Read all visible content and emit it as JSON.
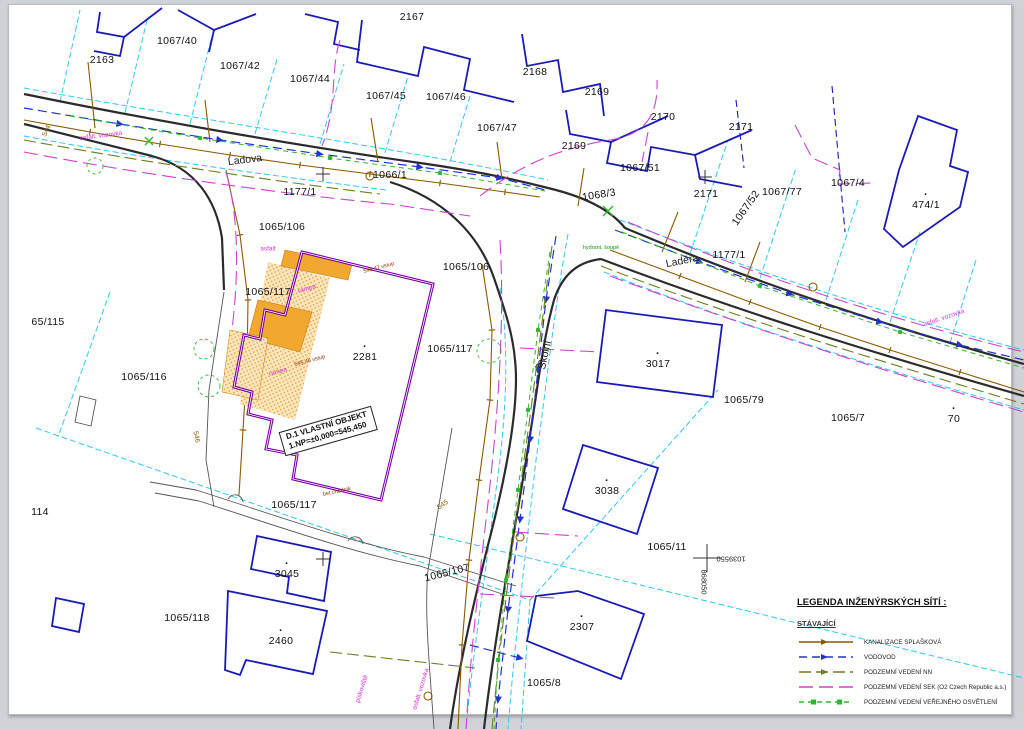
{
  "map": {
    "building_label": {
      "line1": "D.1 VLASTNÍ OBJEKT",
      "line2": "1.NP=±0,000=545,450"
    },
    "legend": {
      "title": "LEGENDA INŽENÝRSKÝCH SÍTÍ :",
      "subtitle": "STÁVAJÍCÍ",
      "items": [
        {
          "label": "KANALIZACE SPLAŠKOVÁ",
          "color": "#8a5a00",
          "dash": "",
          "arrow": true,
          "nodes": false
        },
        {
          "label": "VODOVOD",
          "color": "#2233cc",
          "dash": "8 5",
          "arrow": true,
          "nodes": false
        },
        {
          "label": "PODZEMNÍ VEDENÍ NN",
          "color": "#6f7d20",
          "dash": "12 5",
          "arrow": true,
          "nodes": false
        },
        {
          "label": "PODZEMNÍ VEDENÍ SEK (O2 Czech Republic a.s.)",
          "color": "#cc44cc",
          "dash": "14 6",
          "arrow": false,
          "nodes": false
        },
        {
          "label": "PODZEMNÍ VEDENÍ VEŘEJNÉHO OSVĚTLENÍ",
          "color": "#2eb82e",
          "dash": "5 4",
          "arrow": false,
          "nodes": true
        }
      ]
    },
    "colors": {
      "parcel_line": "#1b1bb4",
      "cadastral_line": "#33c6f0",
      "road_line": "#2b2b2b",
      "sewer": "#8a5a00",
      "water": "#2233cc",
      "power_nn": "#6f7d20",
      "sek": "#cc44cc",
      "lighting": "#2eb82e",
      "building_outline": "#7a00a6",
      "building_fill": "#f5a93c"
    },
    "labels": [
      {
        "name": "parcel-2167",
        "text": "2167",
        "x": 412,
        "y": 17,
        "cls": "p"
      },
      {
        "name": "parcel-1067-40",
        "text": "1067/40",
        "x": 177,
        "y": 41,
        "cls": "p"
      },
      {
        "name": "parcel-2163",
        "text": "2163",
        "x": 102,
        "y": 60,
        "cls": "p"
      },
      {
        "name": "parcel-1067-42",
        "text": "1067/42",
        "x": 240,
        "y": 66,
        "cls": "p"
      },
      {
        "name": "parcel-1067-44",
        "text": "1067/44",
        "x": 310,
        "y": 79,
        "cls": "p"
      },
      {
        "name": "parcel-2168",
        "text": "2168",
        "x": 535,
        "y": 72,
        "cls": "p"
      },
      {
        "name": "parcel-1067-45",
        "text": "1067/45",
        "x": 386,
        "y": 96,
        "cls": "p"
      },
      {
        "name": "parcel-1067-46",
        "text": "1067/46",
        "x": 446,
        "y": 97,
        "cls": "p"
      },
      {
        "name": "parcel-2169-a",
        "text": "2169",
        "x": 597,
        "y": 92,
        "cls": "p"
      },
      {
        "name": "parcel-2170",
        "text": "2170",
        "x": 663,
        "y": 117,
        "cls": "p"
      },
      {
        "name": "parcel-2171-a",
        "text": "2171",
        "x": 741,
        "y": 127,
        "cls": "p"
      },
      {
        "name": "parcel-1067-47",
        "text": "1067/47",
        "x": 497,
        "y": 128,
        "cls": "p"
      },
      {
        "name": "parcel-2169-b",
        "text": "2169",
        "x": 574,
        "y": 146,
        "cls": "p"
      },
      {
        "name": "parcel-1067-51",
        "text": "1067/51",
        "x": 640,
        "y": 168,
        "cls": "p"
      },
      {
        "name": "parcel-2171-b",
        "text": "2171",
        "x": 706,
        "y": 194,
        "cls": "p"
      },
      {
        "name": "parcel-1067-77",
        "text": "1067/77",
        "x": 782,
        "y": 192,
        "cls": "p"
      },
      {
        "name": "parcel-1067-52",
        "text": "1067/52",
        "x": 746,
        "y": 208,
        "rot": -55,
        "cls": "p"
      },
      {
        "name": "parcel-1067-4",
        "text": "1067/4",
        "x": 848,
        "y": 183,
        "cls": "p"
      },
      {
        "name": "parcel-474-1",
        "text": "474/1",
        "x": 926,
        "y": 205,
        "cls": "p",
        "dot": true
      },
      {
        "name": "parcel-1066-1",
        "text": "1066/1",
        "x": 390,
        "y": 175,
        "cls": "p"
      },
      {
        "name": "parcel-1177-1-a",
        "text": "1177/1",
        "x": 300,
        "y": 192,
        "cls": "p"
      },
      {
        "name": "parcel-1068-3",
        "text": "1068/3",
        "x": 599,
        "y": 195,
        "rot": -9,
        "cls": "p"
      },
      {
        "name": "parcel-1177-1-b",
        "text": "1177/1",
        "x": 729,
        "y": 255,
        "cls": "p"
      },
      {
        "name": "parcel-1065-106-a",
        "text": "1065/106",
        "x": 282,
        "y": 227,
        "cls": "p"
      },
      {
        "name": "parcel-1065-106-b",
        "text": "1065/106",
        "x": 466,
        "y": 267,
        "cls": "p"
      },
      {
        "name": "parcel-1065-117-a",
        "text": "1065/117",
        "x": 268,
        "y": 292,
        "cls": "p"
      },
      {
        "name": "parcel-65-115",
        "text": "65/115",
        "x": 48,
        "y": 322,
        "cls": "p"
      },
      {
        "name": "parcel-2281",
        "text": "2281",
        "x": 365,
        "y": 357,
        "cls": "p",
        "dot": true
      },
      {
        "name": "parcel-1065-117-b",
        "text": "1065/117",
        "x": 450,
        "y": 349,
        "cls": "p"
      },
      {
        "name": "parcel-3017",
        "text": "3017",
        "x": 658,
        "y": 364,
        "cls": "p",
        "dot": true
      },
      {
        "name": "parcel-1065-116",
        "text": "1065/116",
        "x": 144,
        "y": 377,
        "cls": "p"
      },
      {
        "name": "parcel-1065-79",
        "text": "1065/79",
        "x": 744,
        "y": 400,
        "cls": "p"
      },
      {
        "name": "parcel-1065-7",
        "text": "1065/7",
        "x": 848,
        "y": 418,
        "cls": "p"
      },
      {
        "name": "parcel-70",
        "text": "70",
        "x": 954,
        "y": 419,
        "cls": "p",
        "dot": true
      },
      {
        "name": "parcel-114",
        "text": "114",
        "x": 40,
        "y": 512,
        "cls": "p"
      },
      {
        "name": "parcel-1065-117-c",
        "text": "1065/117",
        "x": 294,
        "y": 505,
        "cls": "p"
      },
      {
        "name": "parcel-3045",
        "text": "3045",
        "x": 287,
        "y": 574,
        "cls": "p",
        "dot": true
      },
      {
        "name": "parcel-1065-107",
        "text": "1065/107",
        "x": 447,
        "y": 573,
        "rot": -14,
        "cls": "p"
      },
      {
        "name": "parcel-1065-11",
        "text": "1065/11",
        "x": 667,
        "y": 547,
        "cls": "p"
      },
      {
        "name": "parcel-3038",
        "text": "3038",
        "x": 607,
        "y": 491,
        "cls": "p",
        "dot": true
      },
      {
        "name": "parcel-1065-118",
        "text": "1065/118",
        "x": 187,
        "y": 618,
        "cls": "p"
      },
      {
        "name": "parcel-2460",
        "text": "2460",
        "x": 281,
        "y": 641,
        "cls": "p",
        "dot": true
      },
      {
        "name": "parcel-2307",
        "text": "2307",
        "x": 582,
        "y": 627,
        "cls": "p",
        "dot": true
      },
      {
        "name": "parcel-1065-8",
        "text": "1065/8",
        "x": 544,
        "y": 683,
        "cls": "p"
      },
      {
        "name": "street-ladova",
        "text": "Ladova",
        "x": 245,
        "y": 160,
        "rot": -7,
        "cls": "street"
      },
      {
        "name": "street-ladera",
        "text": "Laděra",
        "x": 682,
        "y": 261,
        "rot": -11,
        "cls": "street"
      },
      {
        "name": "street-skolni",
        "text": "Školní",
        "x": 545,
        "y": 355,
        "rot": -78,
        "cls": "street"
      },
      {
        "name": "road-surface-label-a",
        "text": "asfalt. vozovka",
        "x": 101,
        "y": 136,
        "rot": -7,
        "cls": "m"
      },
      {
        "name": "road-surface-label-b",
        "text": "asfalt. vozovka",
        "x": 944,
        "y": 318,
        "rot": -19,
        "cls": "m"
      },
      {
        "name": "surface-label-asfalt",
        "text": "asfalt",
        "x": 268,
        "y": 249,
        "cls": "m"
      },
      {
        "name": "road-surface-label-c",
        "text": "asfalt. vozovka",
        "x": 421,
        "y": 689,
        "rot": -73,
        "cls": "m"
      },
      {
        "name": "surface-label-piskoviste",
        "text": "pískoviště",
        "x": 362,
        "y": 689,
        "rot": -73,
        "cls": "m"
      },
      {
        "name": "surface-label-rampa-a",
        "text": "rampa",
        "x": 307,
        "y": 289,
        "rot": -16,
        "cls": "m"
      },
      {
        "name": "surface-label-rampa-b",
        "text": "rampa",
        "x": 278,
        "y": 372,
        "rot": -16,
        "cls": "m"
      },
      {
        "name": "hydrant-note",
        "text": "hydrant, šoupě",
        "x": 601,
        "y": 248,
        "cls": "g"
      },
      {
        "name": "entry-elevation-a",
        "text": "545,47 vstup",
        "x": 379,
        "y": 268,
        "rot": -15,
        "cls": "r"
      },
      {
        "name": "entry-elevation-b",
        "text": "545,48 vstup",
        "x": 310,
        "y": 361,
        "rot": -15,
        "cls": "r"
      },
      {
        "name": "walkway-note",
        "text": "bet.chodník",
        "x": 337,
        "y": 492,
        "rot": -12,
        "cls": "r"
      },
      {
        "name": "contour-544",
        "text": "544",
        "x": 47,
        "y": 131,
        "rot": -65,
        "cls": "b"
      },
      {
        "name": "contour-545",
        "text": "545",
        "x": 443,
        "y": 505,
        "rot": -35,
        "cls": "b"
      },
      {
        "name": "contour-546",
        "text": "546",
        "x": 196,
        "y": 437,
        "rot": 78,
        "cls": "b"
      },
      {
        "name": "grid-coord-y",
        "text": "1039550",
        "x": 731,
        "y": 559,
        "rot": 180,
        "cls": "c"
      },
      {
        "name": "grid-coord-x",
        "text": "868050",
        "x": 704,
        "y": 582,
        "rot": 90,
        "cls": "c"
      }
    ]
  }
}
